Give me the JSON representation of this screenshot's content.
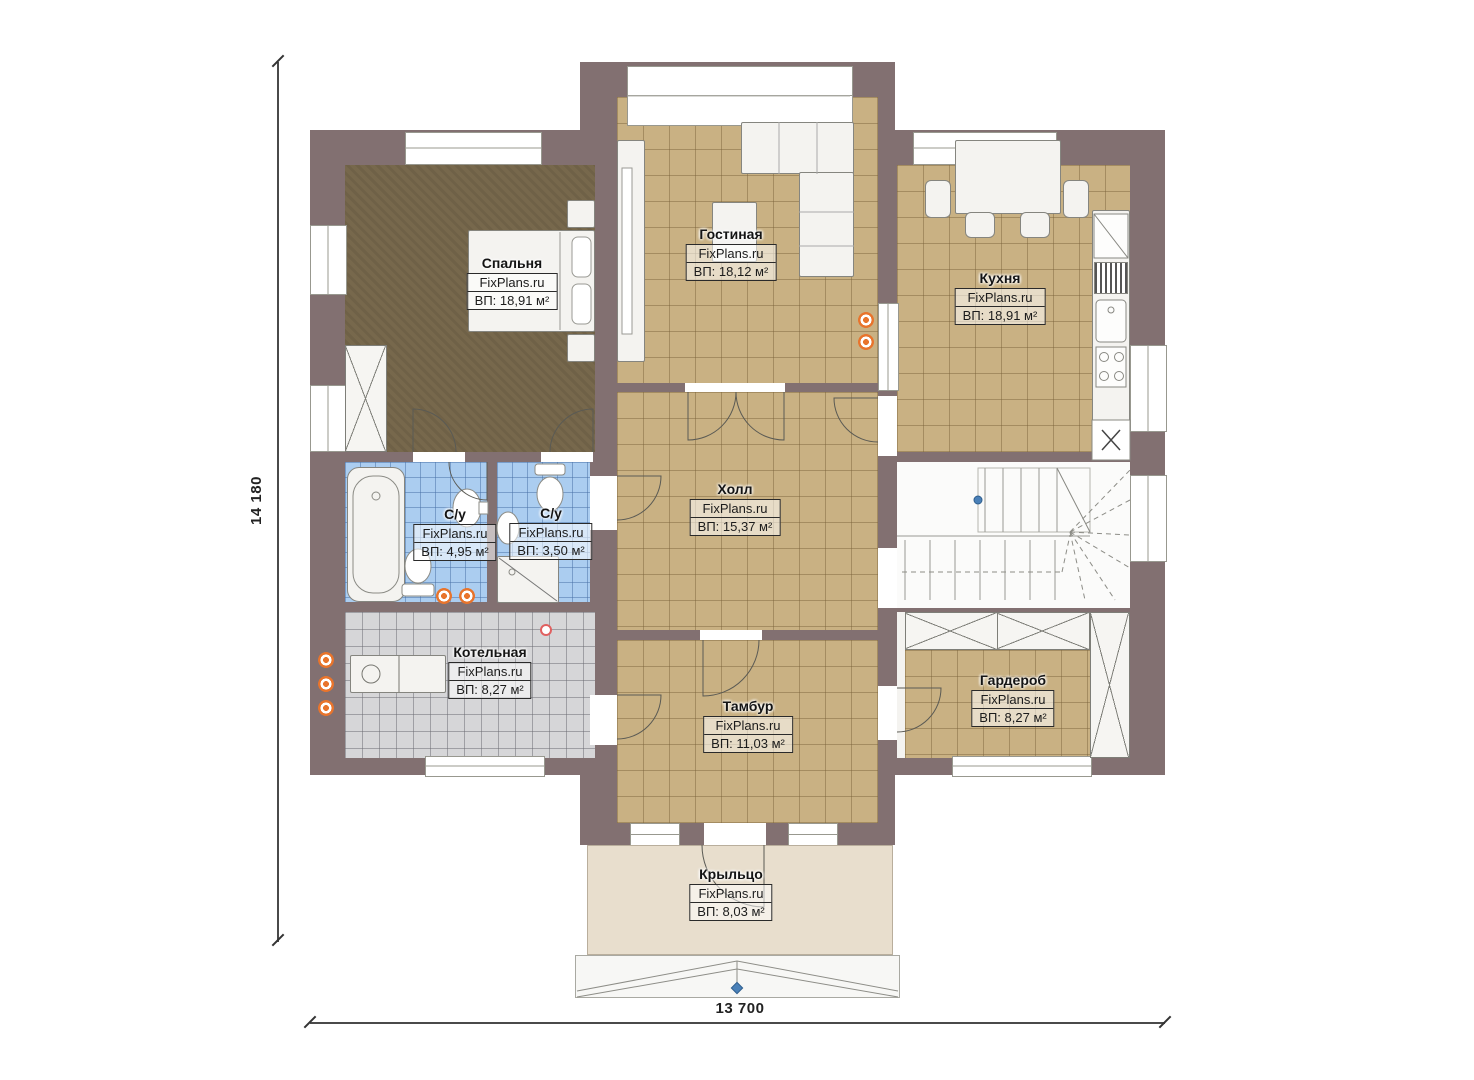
{
  "type": "floor-plan",
  "watermark": "FixPlans.ru",
  "rooms": [
    {
      "name": "Спальня",
      "area": "ВП: 18,91 м²"
    },
    {
      "name": "Гостиная",
      "area": "ВП: 18,12 м²"
    },
    {
      "name": "Кухня",
      "area": "ВП: 18,91 м²"
    },
    {
      "name": "Холл",
      "area": "ВП: 15,37 м²"
    },
    {
      "name": "С/у",
      "area": "ВП: 4,95 м²"
    },
    {
      "name": "С/у",
      "area": "ВП: 3,50 м²"
    },
    {
      "name": "Котельная",
      "area": "ВП: 8,27 м²"
    },
    {
      "name": "Тамбур",
      "area": "ВП: 11,03 м²"
    },
    {
      "name": "Гардероб",
      "area": "ВП: 8,27 м²"
    },
    {
      "name": "Крыльцо",
      "area": "ВП: 8,03 м²"
    }
  ],
  "dimensions": {
    "vertical": "14 180",
    "horizontal": "13 700"
  },
  "colors": {
    "wall": "#827071",
    "tile_tan": "#c9b183",
    "tile_blue": "#abcdf0",
    "tile_gray": "#d6d6d8",
    "carpet_brown": "#77684c",
    "porch": "#e8decd",
    "accent_orange": "#e8742c",
    "marker_blue": "#4a80b8"
  }
}
